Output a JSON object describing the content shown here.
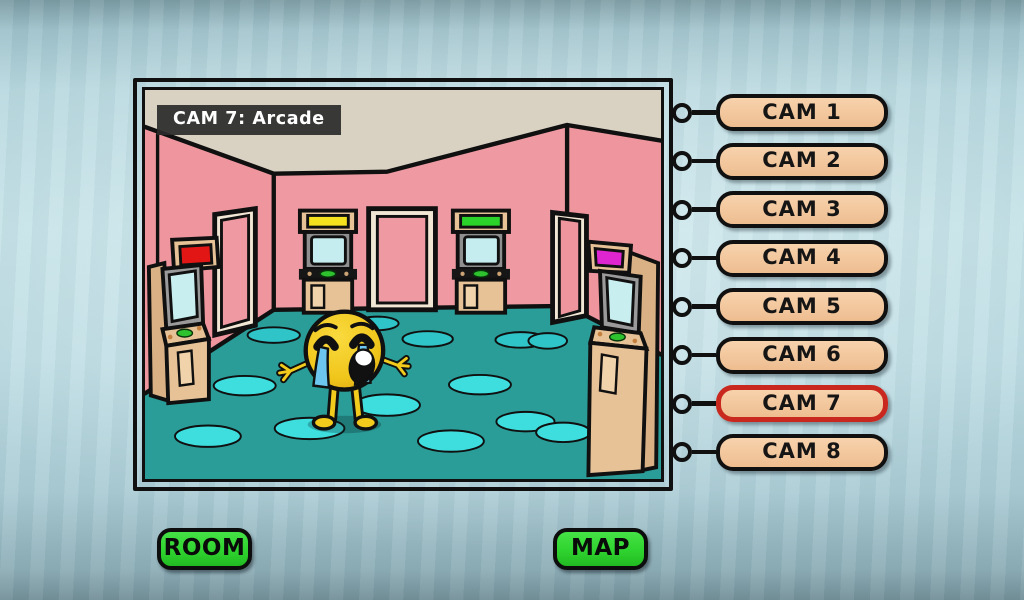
{
  "camera_view": {
    "label": "CAM 7: Arcade",
    "room_name": "Arcade",
    "active_cam": 7
  },
  "cam_buttons": [
    {
      "label": "CAM 1",
      "selected": false
    },
    {
      "label": "CAM 2",
      "selected": false
    },
    {
      "label": "CAM 3",
      "selected": false
    },
    {
      "label": "CAM 4",
      "selected": false
    },
    {
      "label": "CAM 5",
      "selected": false
    },
    {
      "label": "CAM 6",
      "selected": false
    },
    {
      "label": "CAM 7",
      "selected": true
    },
    {
      "label": "CAM 8",
      "selected": false
    }
  ],
  "nav_buttons": {
    "room": "ROOM",
    "map": "MAP"
  },
  "scene": {
    "character": "crying-emoji",
    "objects": [
      "arcade-cabinet-red",
      "arcade-cabinet-yellow",
      "arcade-cabinet-green",
      "arcade-cabinet-magenta",
      "door-left",
      "door-center",
      "door-right"
    ]
  },
  "colors": {
    "background_paper": "#b9d9e0",
    "wall_pink": "#ef9aa2",
    "ceiling_beige": "#d9d1c2",
    "floor_teal": "#2a9d98",
    "floor_spot_cyan": "#3fdede",
    "floor_spot_dark": "#2ec4c8",
    "cabinet_tan": "#e7c296",
    "cam_button_tan": "#f4c9a0",
    "selected_cam_red": "#c8281e",
    "nav_green": "#2fd32f",
    "marquee_red": "#e31616",
    "marquee_yellow": "#f5e11e",
    "marquee_green": "#2ad22a",
    "marquee_magenta": "#df25cf",
    "character_yellow": "#f2cb1d",
    "tear_blue": "#6cc6ee",
    "label_bg": "#3a3a3a"
  }
}
